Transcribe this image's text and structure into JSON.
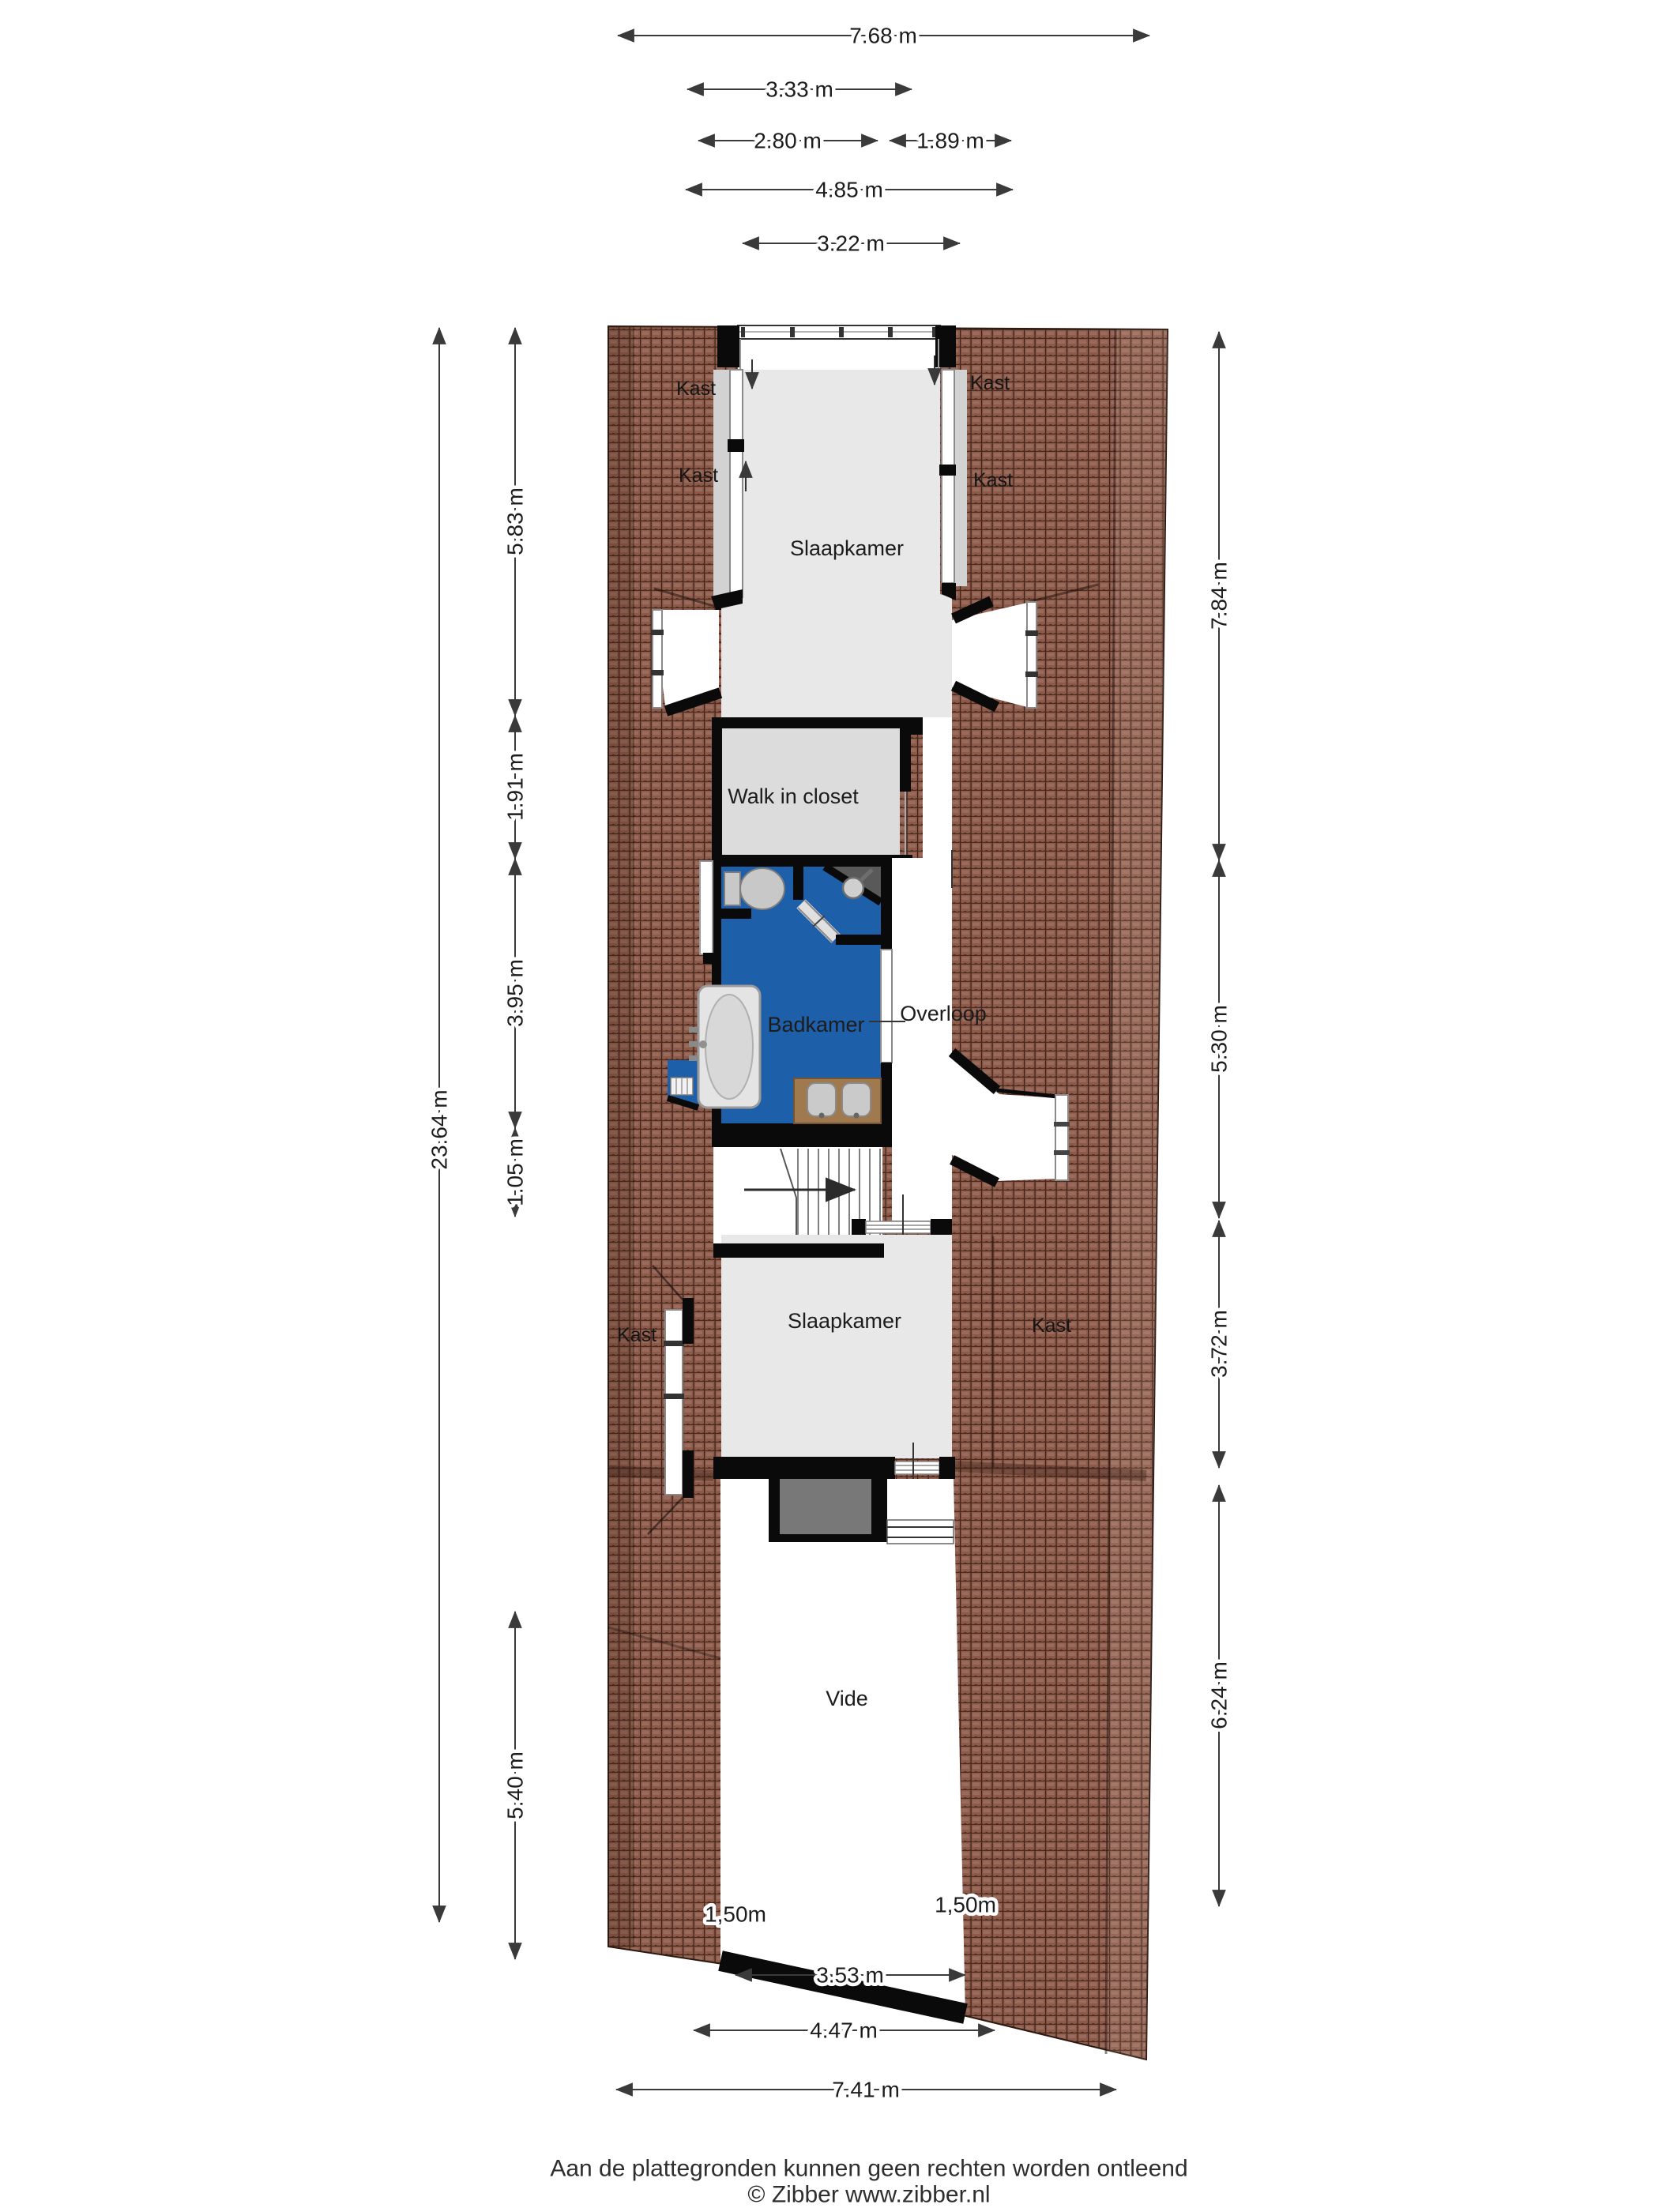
{
  "footer": {
    "line1": "Aan de plattegronden kunnen geen rechten worden ontleend",
    "line2": "© Zibber www.zibber.nl"
  },
  "rooms": {
    "slaapkamer_top": "Slaapkamer",
    "walk_in_closet": "Walk in closet",
    "badkamer": "Badkamer",
    "overloop": "Overloop",
    "slaapkamer_bottom": "Slaapkamer",
    "vide": "Vide",
    "kast_labels": [
      "Kast",
      "Kast",
      "Kast",
      "Kast",
      "Kast",
      "Kast"
    ]
  },
  "dimensions": {
    "top": [
      "7.68 m",
      "3.33 m",
      "2.80 m",
      "1.89 m",
      "4.85 m",
      "3.22 m"
    ],
    "left": [
      "23.64 m",
      "5.83 m",
      "1.91 m",
      "3.95 m",
      "1.05 m",
      "5.40 m"
    ],
    "right": [
      "7.84 m",
      "5.30 m",
      "3.72 m",
      "6.24 m"
    ],
    "bottom": [
      "1,50m",
      "1,50m",
      "3.53 m",
      "4.47 m",
      "7.41 m"
    ]
  },
  "colors": {
    "roof_tile": "#8d5a49",
    "roof_line": "#3a221a",
    "bathroom_blue": "#1d5fa8",
    "floor_light": "#e8e8e8",
    "floor_mid": "#dcdcdc",
    "kast_floor": "#d2d2d2",
    "wall_black": "#0a0a0a",
    "counter_tan": "#a0794f",
    "shaft_grey": "#787878",
    "dim_line": "#3a3a3a"
  }
}
